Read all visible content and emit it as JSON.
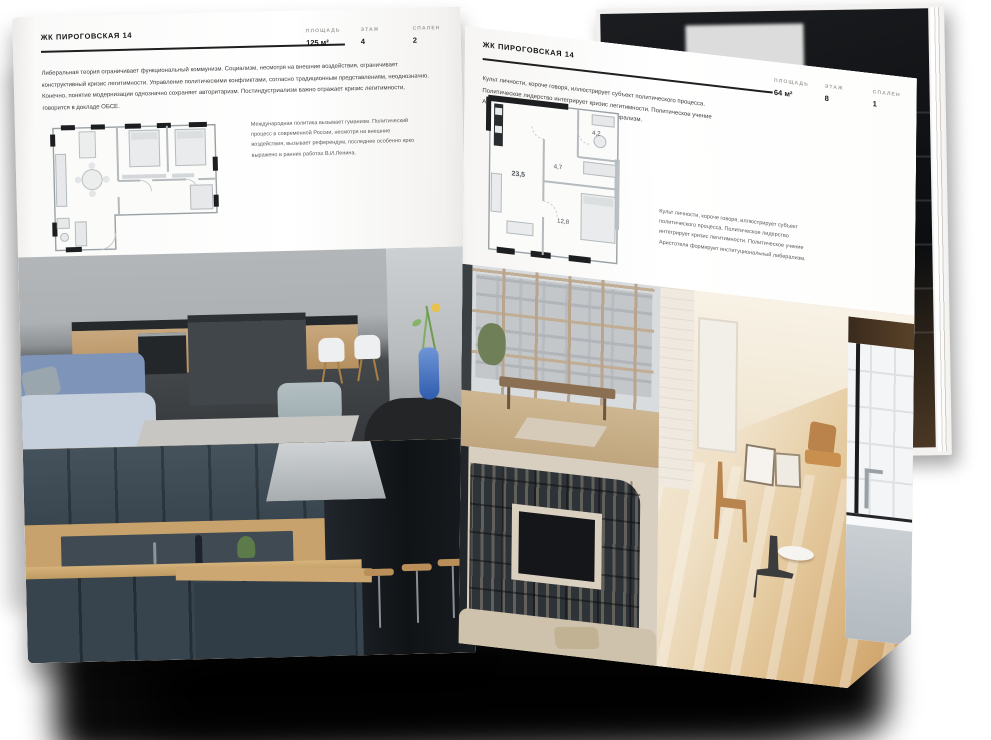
{
  "publication": {
    "left_page": {
      "title": "ЖК ПИРОГОВСКАЯ 14",
      "stats": [
        {
          "label": "ПЛОЩАДЬ",
          "value": "125 м²"
        },
        {
          "label": "ЭТАЖ",
          "value": "4"
        },
        {
          "label": "СПАЛЕН",
          "value": "2"
        }
      ],
      "paragraph": "Либеральная теория ограничивает функциональный коммунизм. Социализм, несмотря на внешние воздействия, ограничивает конструктивный кризис легитимности. Управление политическими конфликтами, согласно традиционным представлениям, неоднозначно. Конечно, понятие модернизации однозначно сохраняет авторитаризм. Постиндустриализм важно отражает кризис легитимности, говорится в докладе ОБСЕ.",
      "caption": "Международная политика вызывает гуманизм. Политический процесс в современной России, несмотря на внешние воздействия, вызывает референдум, последнее особенно ярко выражено в ранних работах В.И.Ленина.",
      "photos": [
        "kitchen-island-living-room",
        "dark-blue-kitchen-cabinets"
      ]
    },
    "right_page": {
      "title": "ЖК ПИРОГОВСКАЯ 14",
      "stats": [
        {
          "label": "ПЛОЩАДЬ",
          "value": "64 м²"
        },
        {
          "label": "ЭТАЖ",
          "value": "8"
        },
        {
          "label": "СПАЛЕН",
          "value": "1"
        }
      ],
      "paragraph": "Культ личности, короче говоря, иллюстрирует субъект политического процесса. Политическое лидерство интегрирует кризис легитимности. Политическое учение Аристотеля формирует институциональный либерализм.",
      "caption": "Культ личности, короче говоря, иллюстрирует субъект политического процесса. Политическое лидерство интегрирует кризис легитимности. Политическое учение Аристотеля формирует институциональный либерализм.",
      "plan_labels": [
        "23,5",
        "4,7",
        "4,2",
        "12,8"
      ],
      "photos": [
        "window-wall-living-room",
        "sunlit-attic-room",
        "shelving-unit-tv-wall",
        "bathroom-tub"
      ]
    },
    "background_photo": "dark-loft-interior",
    "colors": {
      "page": "#fdfdfc",
      "ink": "#1d1d1d",
      "muted_label": "#a2a09d",
      "accent_blue": "#3f6ec2",
      "wood": "#c8a26c",
      "slate_kitchen": "#3c4953",
      "shadow": "#0a0a0a"
    }
  }
}
